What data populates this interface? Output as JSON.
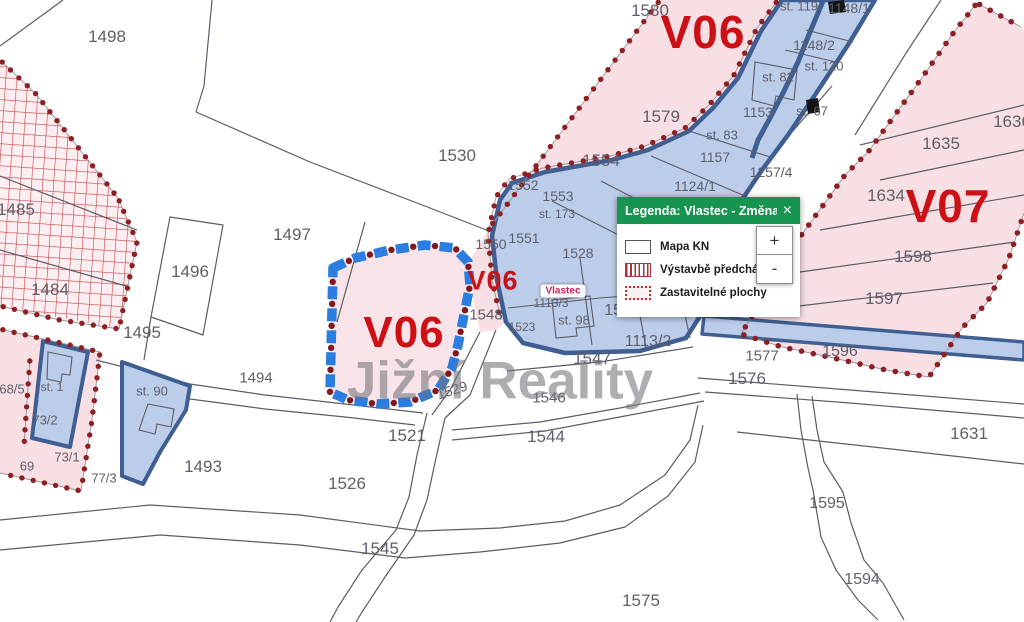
{
  "app": {
    "watermark": "Jižní Reality"
  },
  "legend": {
    "title": "Legenda: Vlastec - Změna ...",
    "close_label": "×",
    "items": [
      {
        "icon": "map-outline-swatch",
        "label": "Mapa KN"
      },
      {
        "icon": "red-hatch-swatch",
        "label": "Výstavbě předchází územn"
      },
      {
        "icon": "red-dotted-swatch",
        "label": "Zastavitelné plochy"
      }
    ],
    "zoom_in": "+",
    "zoom_out": "-"
  },
  "map": {
    "colors": {
      "zone_label_red": "#cb1016",
      "dot_red": "#8e2024",
      "pink_zone": "#f7dfe4",
      "blue_zone_fill": "#bccdea",
      "blue_zone_border": "#3f5f92",
      "dashed_zone_blue": "#2b7de0",
      "legend_green": "#179450",
      "parcel_number_gray": "#5f5f6a"
    },
    "labels": [
      {
        "t": "V06",
        "x": 703,
        "y": 32,
        "s": 46,
        "c": "zone"
      },
      {
        "t": "V07",
        "x": 948,
        "y": 206,
        "s": 46,
        "c": "zone"
      },
      {
        "t": "V06",
        "x": 404,
        "y": 333,
        "s": 44,
        "c": "zone"
      },
      {
        "t": "V06",
        "x": 493,
        "y": 281,
        "s": 27,
        "c": "zone"
      },
      {
        "t": "Vlastec",
        "x": 563,
        "y": 291,
        "c": "town"
      },
      {
        "t": "1498",
        "x": 107,
        "y": 37
      },
      {
        "t": "1580",
        "x": 650,
        "y": 11
      },
      {
        "t": "1530",
        "x": 457,
        "y": 156
      },
      {
        "t": "1579",
        "x": 661,
        "y": 117
      },
      {
        "t": "1554",
        "x": 601,
        "y": 161
      },
      {
        "t": "1496",
        "x": 190,
        "y": 272
      },
      {
        "t": "1497",
        "x": 292,
        "y": 235
      },
      {
        "t": "1485",
        "x": 16,
        "y": 210
      },
      {
        "t": "1484",
        "x": 50,
        "y": 290
      },
      {
        "t": "1495",
        "x": 142,
        "y": 333
      },
      {
        "t": "1494",
        "x": 256,
        "y": 378,
        "s": 15
      },
      {
        "t": "1493",
        "x": 203,
        "y": 467
      },
      {
        "t": "1526",
        "x": 347,
        "y": 484
      },
      {
        "t": "1521",
        "x": 407,
        "y": 436
      },
      {
        "t": "1529",
        "x": 452,
        "y": 390,
        "s": 14,
        "r": -18
      },
      {
        "t": "1544",
        "x": 546,
        "y": 437
      },
      {
        "t": "1545",
        "x": 380,
        "y": 549
      },
      {
        "t": "1546",
        "x": 549,
        "y": 398,
        "s": 15
      },
      {
        "t": "1547",
        "x": 592,
        "y": 359
      },
      {
        "t": "1575",
        "x": 641,
        "y": 601
      },
      {
        "t": "1595",
        "x": 827,
        "y": 504,
        "s": 16
      },
      {
        "t": "1594",
        "x": 862,
        "y": 580,
        "s": 16
      },
      {
        "t": "1631",
        "x": 969,
        "y": 434
      },
      {
        "t": "1576",
        "x": 747,
        "y": 379
      },
      {
        "t": "1577",
        "x": 762,
        "y": 356,
        "s": 15
      },
      {
        "t": "1596",
        "x": 840,
        "y": 352,
        "s": 16
      },
      {
        "t": "1597",
        "x": 884,
        "y": 299
      },
      {
        "t": "1598",
        "x": 913,
        "y": 257
      },
      {
        "t": "1634",
        "x": 886,
        "y": 196
      },
      {
        "t": "1635",
        "x": 941,
        "y": 144
      },
      {
        "t": "1636",
        "x": 1012,
        "y": 122
      },
      {
        "t": "1553",
        "x": 558,
        "y": 196,
        "s": 14
      },
      {
        "t": "1552",
        "x": 523,
        "y": 185,
        "s": 14
      },
      {
        "t": "st. 173",
        "x": 557,
        "y": 214,
        "s": 12
      },
      {
        "t": "1551",
        "x": 524,
        "y": 238,
        "s": 14
      },
      {
        "t": "1550",
        "x": 491,
        "y": 244,
        "s": 14
      },
      {
        "t": "1528",
        "x": 578,
        "y": 253,
        "s": 14
      },
      {
        "t": "1548",
        "x": 486,
        "y": 315,
        "s": 15
      },
      {
        "t": "1523",
        "x": 522,
        "y": 327,
        "s": 12
      },
      {
        "t": "1113/3",
        "x": 551,
        "y": 303,
        "s": 12
      },
      {
        "t": "st. 98",
        "x": 574,
        "y": 320,
        "s": 13
      },
      {
        "t": "1549",
        "x": 622,
        "y": 311,
        "s": 16
      },
      {
        "t": "1378",
        "x": 655,
        "y": 297,
        "s": 14
      },
      {
        "t": "1113/2",
        "x": 648,
        "y": 342,
        "s": 16
      },
      {
        "t": "1124/1",
        "x": 695,
        "y": 186,
        "s": 14
      },
      {
        "t": "1257/4",
        "x": 771,
        "y": 172,
        "s": 14
      },
      {
        "t": "1157",
        "x": 715,
        "y": 157,
        "s": 14
      },
      {
        "t": "st. 83",
        "x": 722,
        "y": 135,
        "s": 13
      },
      {
        "t": "1153",
        "x": 758,
        "y": 112,
        "s": 14
      },
      {
        "t": "st. 67",
        "x": 812,
        "y": 111,
        "s": 13
      },
      {
        "t": "st. 82",
        "x": 778,
        "y": 77,
        "s": 13
      },
      {
        "t": "st. 120",
        "x": 824,
        "y": 66,
        "s": 13
      },
      {
        "t": "1148/2",
        "x": 814,
        "y": 45,
        "s": 14
      },
      {
        "t": "st. 119",
        "x": 799,
        "y": 6,
        "s": 13
      },
      {
        "t": "1148/1",
        "x": 849,
        "y": 8,
        "s": 14
      },
      {
        "t": "68/5",
        "x": 12,
        "y": 389,
        "s": 13
      },
      {
        "t": "st. 1",
        "x": 52,
        "y": 387,
        "s": 12
      },
      {
        "t": "73/2",
        "x": 45,
        "y": 420,
        "s": 13
      },
      {
        "t": "73/1",
        "x": 67,
        "y": 457,
        "s": 13
      },
      {
        "t": "69",
        "x": 27,
        "y": 466,
        "s": 13
      },
      {
        "t": "77/3",
        "x": 104,
        "y": 478,
        "s": 13
      },
      {
        "t": "st. 90",
        "x": 152,
        "y": 391,
        "s": 13
      }
    ]
  }
}
